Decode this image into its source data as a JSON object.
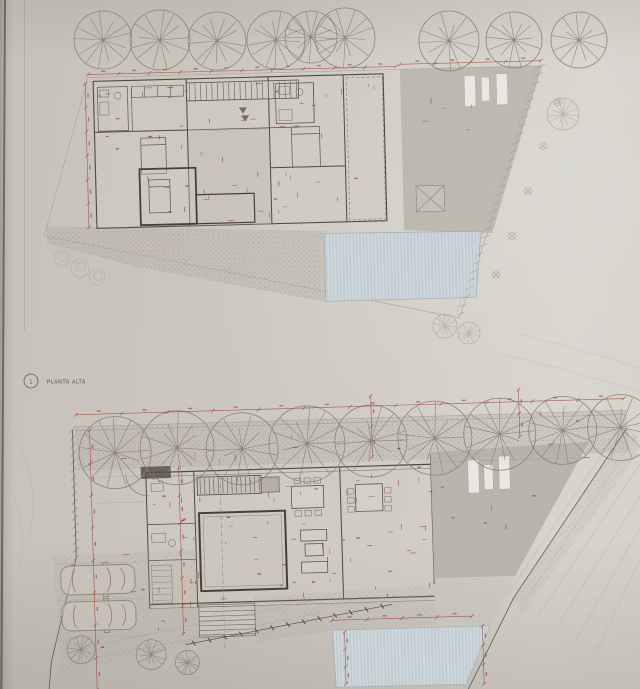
{
  "labels": {
    "upper_plan_marker": "1",
    "upper_plan_title": "PLANTA ALTA"
  },
  "colors": {
    "paper": "#cbc6bd",
    "paper_light": "#d7d4cd",
    "paper_dark": "#b9b3a8",
    "edge_shadow": "#57524b",
    "ink": "#5a544a",
    "ink_light": "#8d8679",
    "ink_faint": "#a39c8f",
    "wall": "#4f4941",
    "red": "#a03a31",
    "pool_fill": "#cdd6da",
    "pool_stripe": "#bdc9cf",
    "gray_fill": "#b5b0a7",
    "white_fill": "#e9e7e2",
    "stipple": "#8f887b",
    "tree": "#847d6f"
  },
  "scene": {
    "type": "photograph of an architectural drawing sheet with two floor plans",
    "upper_plan": "PLANTA ALTA - upper floor: two room wings linked by a stair bridge over a courtyard, roof terrace with skylights at right, lap pool and gravel terrace below, row of trees above, red dimension chains",
    "lower_plan": "ground floor (label not visible): kitchen stair and counter, two dining tables, enclosed patio, lounge sofas, rear gray court at right, two parked cars and exterior steps at lower left, lap pool at bottom, tree row and planted slope along boundaries, red dimension chains"
  }
}
